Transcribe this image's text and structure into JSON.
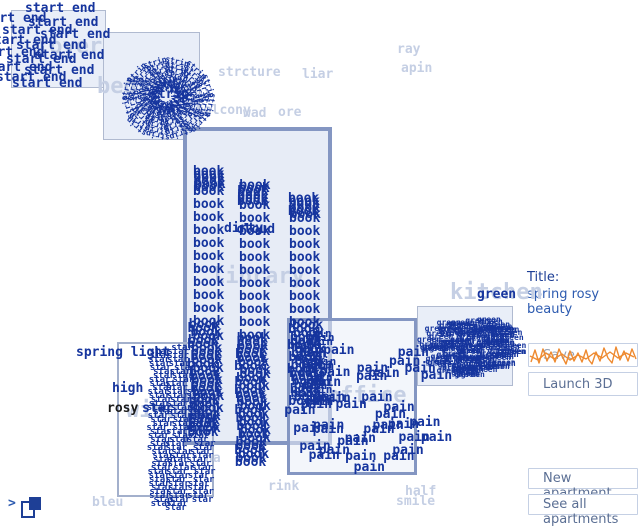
{
  "colors": {
    "ink": "#16359e",
    "faint": "#c5cfe4",
    "accent": "#ee8a30",
    "boxfill": "#e9eef8",
    "bthin": "#b0bad0",
    "bthick": "#8496c2",
    "btntext": "#5b6f94",
    "titlecol": "#2d5bb0",
    "navy": "#1e3f96",
    "black_word": "#1b1b1b"
  },
  "panel": {
    "title_label": "Title:",
    "title_value": "spring rosy beauty",
    "save": "Save",
    "launch": "Launch 3D",
    "new_apartment": "New apartment",
    "see_all": "See all apartments"
  },
  "toggle": {
    "chevron": ">"
  },
  "boxes": [
    {
      "name": "foyer",
      "x": 11,
      "y": 10,
      "w": 95,
      "h": 78,
      "fill": "#e9eef8",
      "border": "1px solid #b0bad0"
    },
    {
      "name": "bedroom",
      "x": 103,
      "y": 32,
      "w": 97,
      "h": 108,
      "fill": "#e9eef8",
      "border": "1px solid #b0bad0"
    },
    {
      "name": "library",
      "x": 183,
      "y": 127,
      "w": 149,
      "h": 318,
      "fill": "#e7ecf6",
      "border": "4px solid #8496c2"
    },
    {
      "name": "kitchen",
      "x": 417,
      "y": 306,
      "w": 96,
      "h": 80,
      "fill": "#e9eef8",
      "border": "1px solid #b0bad0"
    },
    {
      "name": "office",
      "x": 287,
      "y": 318,
      "w": 130,
      "h": 157,
      "fill": "rgba(234,239,248,0.55)",
      "border": "3px solid #8496c2"
    },
    {
      "name": "window",
      "x": 117,
      "y": 342,
      "w": 97,
      "h": 155,
      "fill": "transparent",
      "border": "2px solid #a3b0cc"
    }
  ],
  "faint_labels": [
    {
      "text": "foyer",
      "x": 36,
      "y": 36,
      "size": 22
    },
    {
      "text": "bedroom",
      "x": 97,
      "y": 76,
      "size": 22
    },
    {
      "text": "library",
      "x": 212,
      "y": 266,
      "size": 22
    },
    {
      "text": "window",
      "x": 126,
      "y": 400,
      "size": 22
    },
    {
      "text": "office",
      "x": 327,
      "y": 385,
      "size": 22
    },
    {
      "text": "kitchen",
      "x": 450,
      "y": 282,
      "size": 22
    },
    {
      "text": "strcture",
      "x": 218,
      "y": 66,
      "size": 13
    },
    {
      "text": "liar",
      "x": 302,
      "y": 68,
      "size": 13
    },
    {
      "text": "balcony",
      "x": 196,
      "y": 104,
      "size": 13
    },
    {
      "text": "wad",
      "x": 243,
      "y": 107,
      "size": 13
    },
    {
      "text": "ore",
      "x": 278,
      "y": 106,
      "size": 13
    },
    {
      "text": "ray",
      "x": 397,
      "y": 43,
      "size": 13
    },
    {
      "text": "apin",
      "x": 401,
      "y": 62,
      "size": 13
    },
    {
      "text": "na",
      "x": 205,
      "y": 452,
      "size": 13
    },
    {
      "text": "rink",
      "x": 268,
      "y": 480,
      "size": 13
    },
    {
      "text": "half",
      "x": 405,
      "y": 485,
      "size": 13
    },
    {
      "text": "smile",
      "x": 396,
      "y": 495,
      "size": 13
    },
    {
      "text": "bleu",
      "x": 92,
      "y": 496,
      "size": 13
    }
  ],
  "bold_words": [
    {
      "text": "spring light",
      "x": 76,
      "y": 346,
      "size": 13
    },
    {
      "text": "high",
      "x": 112,
      "y": 382,
      "size": 13
    },
    {
      "text": "rosy",
      "x": 107,
      "y": 402,
      "size": 13,
      "color": "#1b1b1b"
    },
    {
      "text": "star",
      "x": 142,
      "y": 402,
      "size": 13
    },
    {
      "text": "green",
      "x": 477,
      "y": 288,
      "size": 13
    },
    {
      "text": "strip",
      "x": 150,
      "y": 88,
      "size": 13
    },
    {
      "text": "dirty",
      "x": 224,
      "y": 222,
      "size": 13
    },
    {
      "text": "cloud",
      "x": 236,
      "y": 223,
      "size": 13
    }
  ],
  "clusters": [
    {
      "type": "placed",
      "word": "start end",
      "size": 13,
      "positions": [
        [
          25,
          2
        ],
        [
          -24,
          12
        ],
        [
          28,
          16
        ],
        [
          2,
          24
        ],
        [
          40,
          28
        ],
        [
          -14,
          34
        ],
        [
          16,
          39
        ],
        [
          -26,
          46
        ],
        [
          34,
          49
        ],
        [
          6,
          53
        ],
        [
          -18,
          61
        ],
        [
          24,
          64
        ],
        [
          -4,
          71
        ],
        [
          12,
          77
        ]
      ]
    },
    {
      "type": "spiral",
      "word": "strip",
      "size": 8,
      "cx": 163,
      "cy": 97,
      "r0": 6,
      "r1": 46,
      "count": 90,
      "seed": 3
    },
    {
      "type": "dense",
      "word": "book",
      "size": 13,
      "x": 193,
      "y": 165,
      "yEnd": 182,
      "step": 3.2,
      "jitter": 2,
      "seed": 11
    },
    {
      "type": "column",
      "word": "book",
      "size": 13,
      "x": 193,
      "y": 185,
      "step": 13,
      "count": 11
    },
    {
      "type": "dense",
      "word": "book",
      "size": 13,
      "x": 190,
      "y": 318,
      "yEnd": 428,
      "step": 4,
      "jitter": 3,
      "seed": 12
    },
    {
      "type": "dense",
      "word": "book",
      "size": 13,
      "x": 239,
      "y": 179,
      "yEnd": 196,
      "step": 3.2,
      "jitter": 2,
      "seed": 13
    },
    {
      "type": "column",
      "word": "book",
      "size": 13,
      "x": 239,
      "y": 199,
      "step": 13,
      "count": 11
    },
    {
      "type": "dense",
      "word": "book",
      "size": 13,
      "x": 237,
      "y": 332,
      "yEnd": 458,
      "step": 4,
      "jitter": 3,
      "seed": 14
    },
    {
      "type": "dense",
      "word": "book",
      "size": 13,
      "x": 289,
      "y": 192,
      "yEnd": 209,
      "step": 3.2,
      "jitter": 2,
      "seed": 15
    },
    {
      "type": "column",
      "word": "book",
      "size": 13,
      "x": 289,
      "y": 212,
      "step": 13,
      "count": 9
    },
    {
      "type": "dense",
      "word": "book",
      "size": 13,
      "x": 291,
      "y": 319,
      "yEnd": 398,
      "step": 4,
      "jitter": 4,
      "seed": 16
    },
    {
      "type": "dense",
      "word": "star",
      "size": 9,
      "x": 150,
      "y": 348,
      "yEnd": 500,
      "step": 4,
      "jitter": 4,
      "seed": 21
    },
    {
      "type": "dense",
      "word": "star",
      "size": 9,
      "x": 170,
      "y": 344,
      "yEnd": 505,
      "step": 4,
      "jitter": 5,
      "seed": 22
    },
    {
      "type": "dense",
      "word": "star",
      "size": 9,
      "x": 190,
      "y": 388,
      "yEnd": 498,
      "step": 4,
      "jitter": 4,
      "seed": 23
    },
    {
      "type": "dense",
      "word": "pain",
      "size": 11,
      "x": 302,
      "y": 328,
      "yEnd": 398,
      "step": 4,
      "jitter": 9,
      "seed": 31
    },
    {
      "type": "scatter",
      "word": "pain",
      "size": 13,
      "x": 283,
      "y": 330,
      "w": 140,
      "h": 132,
      "count": 38,
      "seed": 32
    },
    {
      "type": "blob",
      "word": "green",
      "size": 8,
      "cx": 468,
      "cy": 346,
      "rx": 44,
      "ry": 30,
      "count": 140,
      "seed": 41
    }
  ]
}
